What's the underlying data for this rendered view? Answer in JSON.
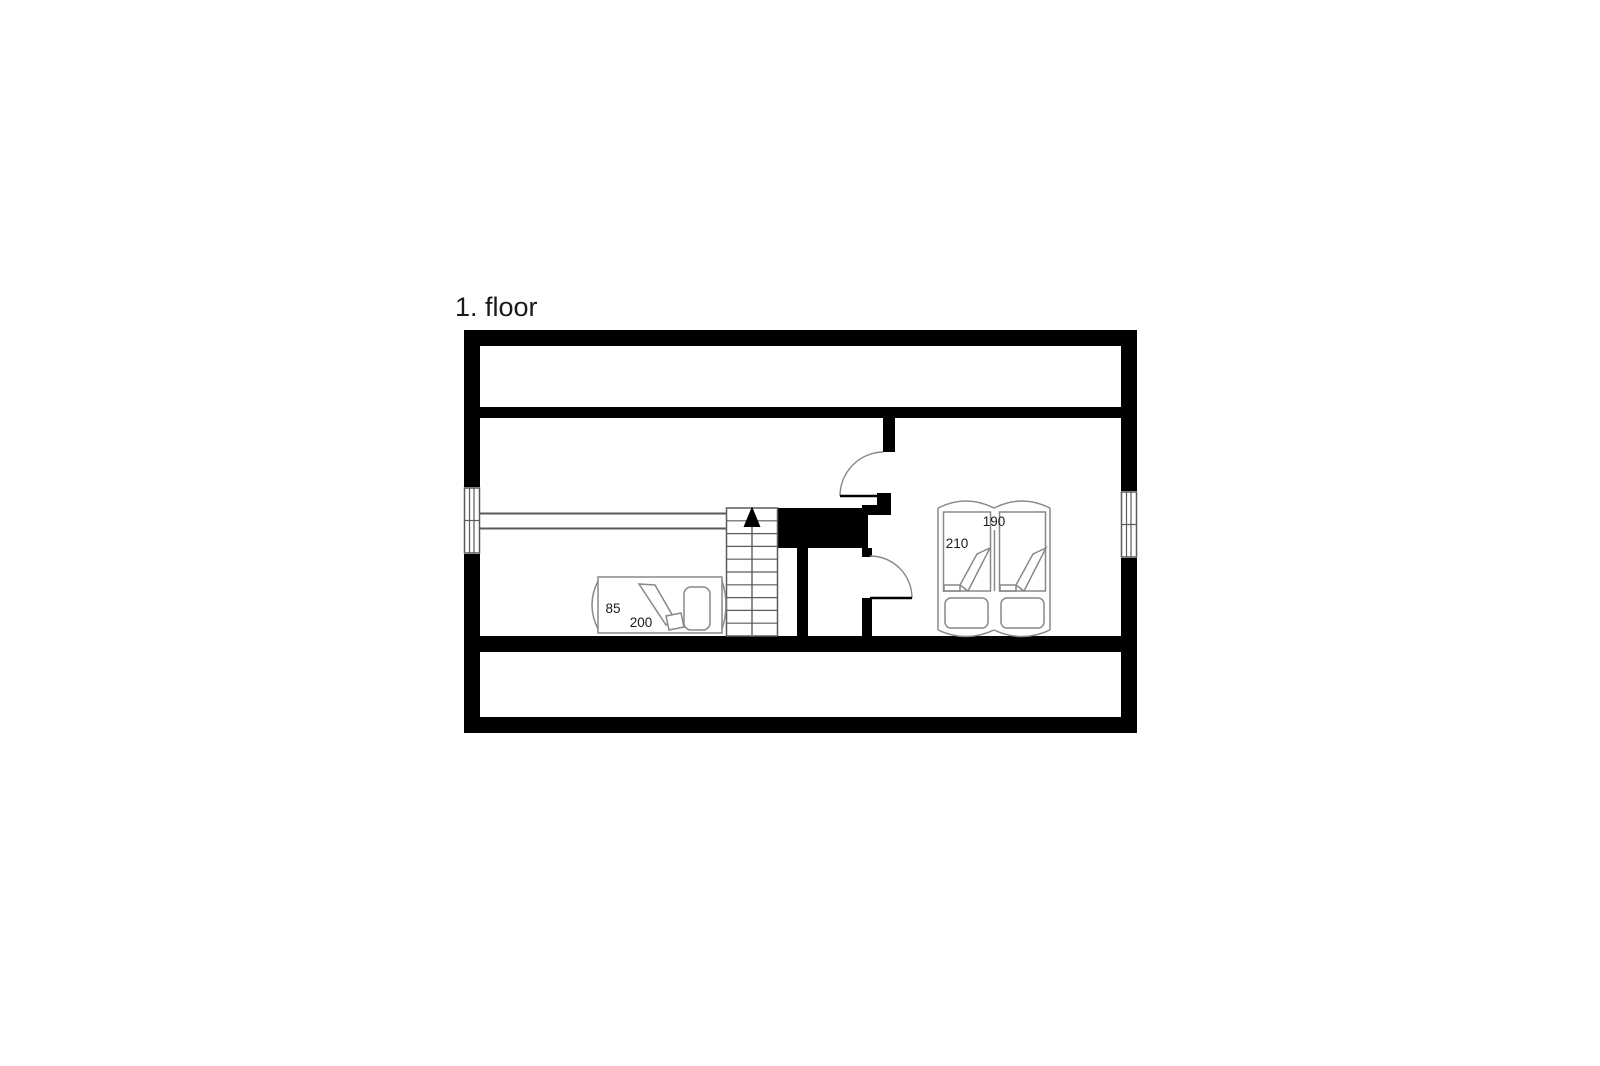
{
  "title": "1. floor",
  "colors": {
    "wall": "#000000",
    "line": "#888888",
    "line_dark": "#5a5a5a",
    "text": "#1a1a1a",
    "background": "#ffffff"
  },
  "stairs": {
    "arrow": "up"
  },
  "furniture": {
    "single_bed": {
      "width_label": "85",
      "length_label": "200"
    },
    "double_bed": {
      "length_label": "210",
      "width_label": "190"
    }
  }
}
